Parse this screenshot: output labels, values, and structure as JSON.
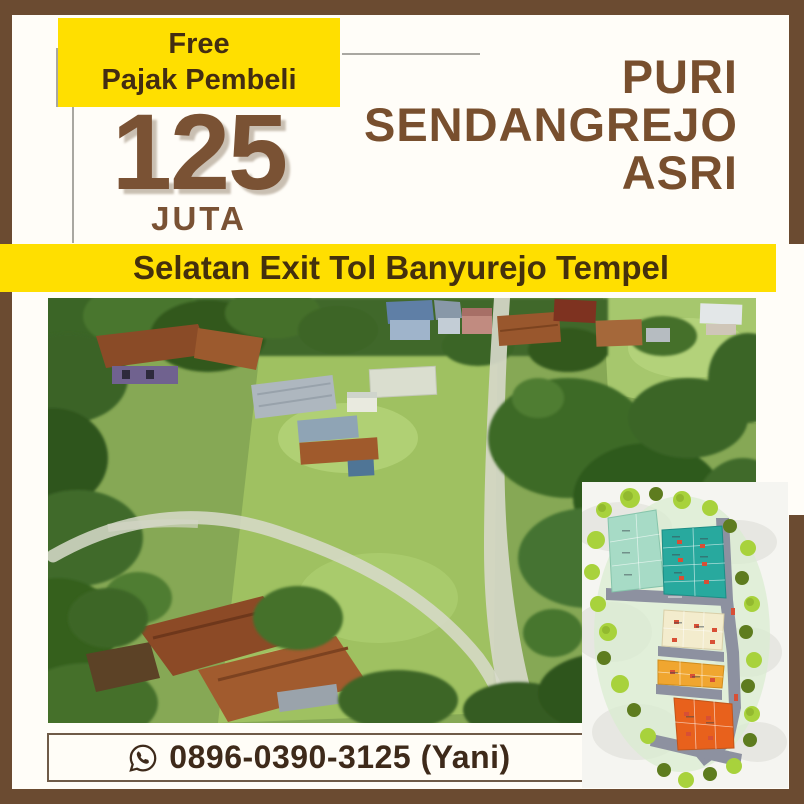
{
  "poster": {
    "badge": {
      "line1": "Free",
      "line2": "Pajak Pembeli"
    },
    "price": {
      "amount": "125",
      "unit": "JUTA"
    },
    "title": {
      "line1": "PURI",
      "line2": "SENDANGREJO",
      "line3": "ASRI"
    },
    "banner_text": "Selatan Exit Tol Banyurejo Tempel",
    "contact": {
      "phone": "0896-0390-3125 (Yani)",
      "icon": "whatsapp-icon"
    },
    "media": {
      "aerial_photo_alt": "Aerial drone photo of a green land plot beside village houses and trees",
      "site_plan_alt": "Site plan inset with color-coded lot blocks, roads and trees"
    },
    "colors": {
      "frame_brown": "#6b4b31",
      "accent_yellow": "#ffdf00",
      "heading_brown": "#784f2e",
      "price_brown": "#7a5234",
      "dark_brown_text": "#432d12",
      "phone_text": "#3e2a1a"
    }
  }
}
